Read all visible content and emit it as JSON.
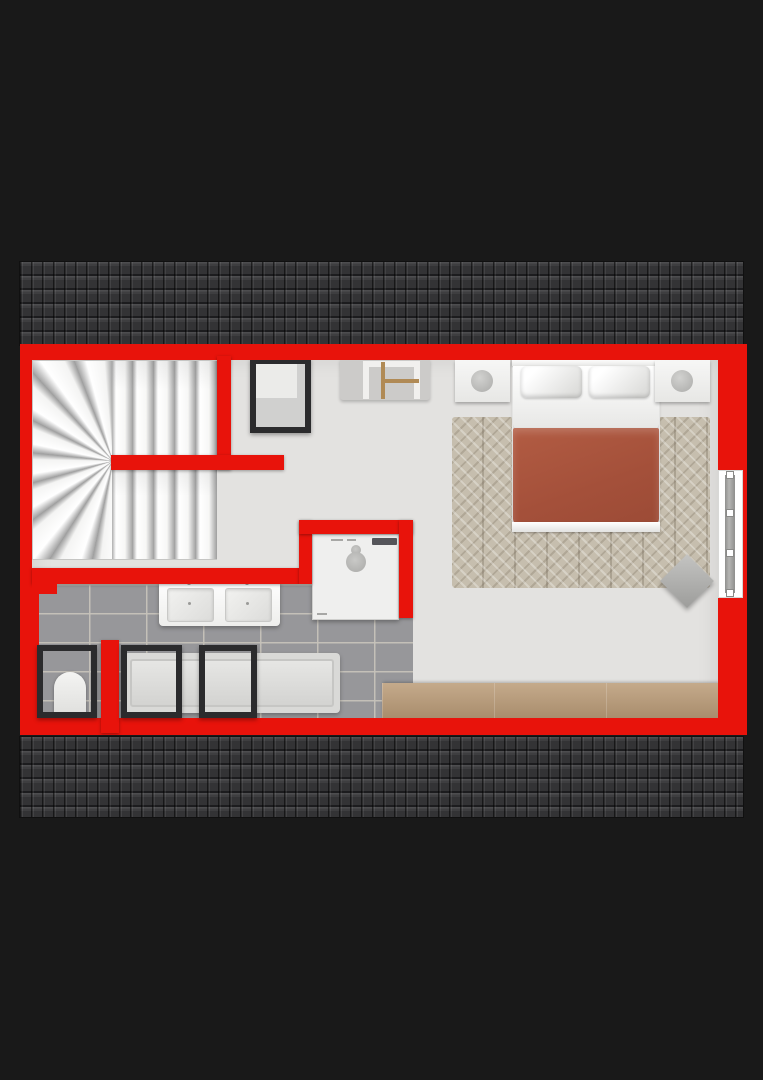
{
  "title": "Attic floor plan",
  "colors": {
    "wall": "#e8130b",
    "roof_tiles": "#353537",
    "floor": "#e3e2e0",
    "bathroom_tile": "#97979a",
    "wood_cabinet": "#bb9c78",
    "duvet": "#a4503a",
    "rug": "#c6beae",
    "frame_dark": "#2b2b2d",
    "background": "#191919"
  },
  "rooms": {
    "bedroom": {
      "label": "Bedroom"
    },
    "bathroom": {
      "label": "Bathroom"
    },
    "landing": {
      "label": "Landing / hall"
    },
    "stairwell": {
      "label": "Stairwell"
    }
  },
  "elements": {
    "roof_top": {
      "label": "Roof tiles (upper slope)"
    },
    "roof_bottom": {
      "label": "Roof tiles (lower slope)"
    },
    "staircase": {
      "label": "U-shaped winder staircase"
    },
    "bed": {
      "label": "Double bed with terracotta duvet"
    },
    "pillow_left": {
      "label": "Pillow"
    },
    "pillow_right": {
      "label": "Pillow"
    },
    "nightstand_left": {
      "label": "Nightstand with lamp"
    },
    "nightstand_right": {
      "label": "Nightstand with lamp"
    },
    "rug": {
      "label": "Patterned area rug"
    },
    "pouf": {
      "label": "Pouf"
    },
    "window_right": {
      "label": "Window in right wall"
    },
    "roof_window_hall": {
      "label": "Roof window (hall)"
    },
    "desk_chair": {
      "label": "Desk with wooden chair"
    },
    "vanity": {
      "label": "Double washbasin vanity"
    },
    "washer": {
      "label": "Washing machine"
    },
    "bathtub": {
      "label": "Bathtub"
    },
    "skylight_toilet": {
      "label": "Roof window above toilet"
    },
    "skylight_tub_1": {
      "label": "Roof window above bathtub"
    },
    "skylight_tub_2": {
      "label": "Roof window above bathtub"
    },
    "toilet": {
      "label": "Toilet"
    },
    "wood_cabinet": {
      "label": "Low wooden cabinet"
    }
  }
}
